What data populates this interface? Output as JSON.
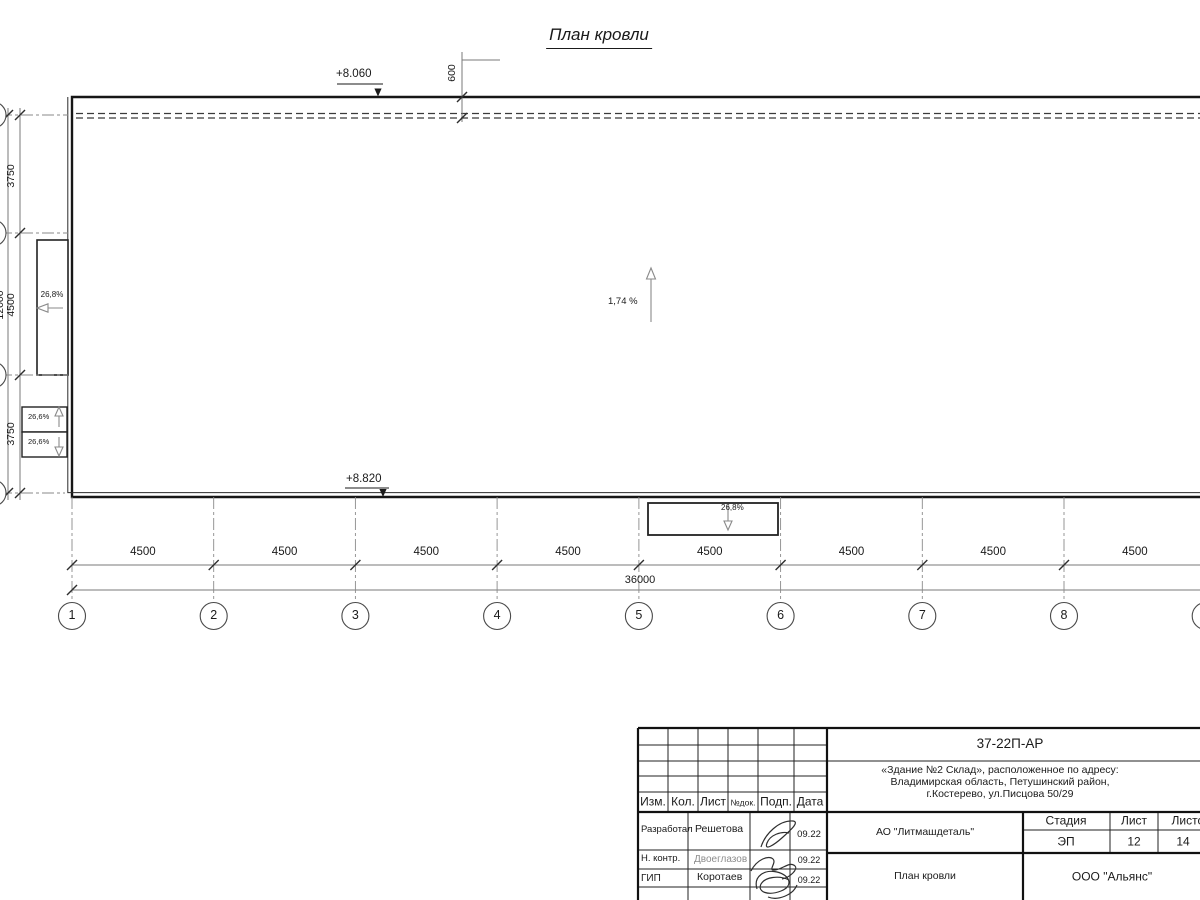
{
  "title": "План кровли",
  "plan": {
    "elev_top": "+8.060",
    "elev_bottom": "+8.820",
    "parapet_offset": "600",
    "main_slope": "1,74 %",
    "left_canopy_slope": "26,8%",
    "left_box_top_slope": "26,6%",
    "left_box_bottom_slope": "26,6%",
    "bottom_canopy_slope": "26,8%"
  },
  "dims": {
    "bottom_segments": [
      "4500",
      "4500",
      "4500",
      "4500",
      "4500",
      "4500",
      "4500",
      "4500"
    ],
    "bottom_overall": "36000",
    "left_top": "3750",
    "left_middle": "4500",
    "left_bottom": "3750",
    "left_overall": "12000"
  },
  "axes": [
    "1",
    "2",
    "3",
    "4",
    "5",
    "6",
    "7",
    "8",
    "9"
  ],
  "titleblock": {
    "doc_number": "37-22П-АР",
    "address_line1": "«Здание №2 Склад», расположенное по адресу:",
    "address_line2": "Владимирская область, Петушинский район,",
    "address_line3": "г.Костерево, ул.Писцова 50/29",
    "col_izm": "Изм.",
    "col_kol": "Кол.",
    "col_list": "Лист",
    "col_ndok": "№док.",
    "col_podp": "Подп.",
    "col_data": "Дата",
    "row1_role": "Разработал",
    "row1_name": "Решетова",
    "row1_date": "09.22",
    "row2_role": "Н. контр.",
    "row2_name": "Двоеглазов",
    "row2_date": "09.22",
    "row3_role": "ГИП",
    "row3_name": "Коротаев",
    "row3_date": "09.22",
    "company": "АО \"Литмашдеталь\"",
    "sheet_name": "План кровли",
    "org": "ООО \"Альянс\"",
    "stage_label": "Стадия",
    "sheet_label": "Лист",
    "sheets_label": "Листов",
    "stage": "ЭП",
    "sheet_no": "12",
    "sheets_total": "14"
  }
}
